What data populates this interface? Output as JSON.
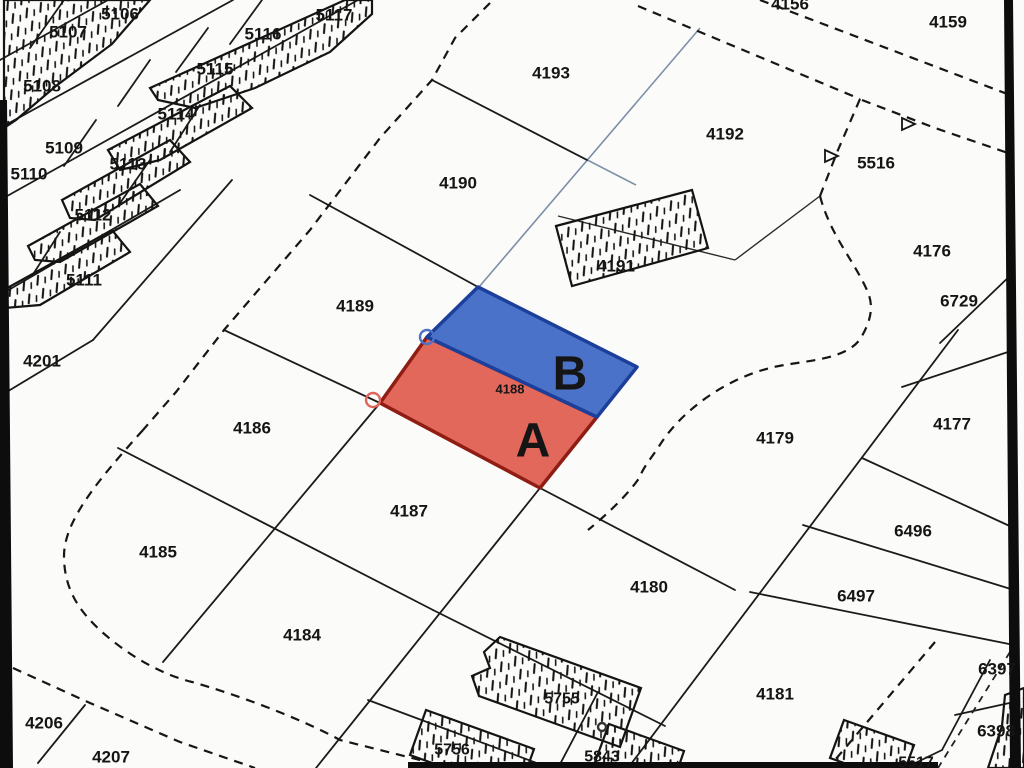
{
  "map": {
    "type": "cadastral-parcel-map",
    "background": "#fbfbf9",
    "ink_color": "#1b1b1b",
    "survey_line_color": "#7d8fa8",
    "highlight": {
      "parcel_number": "4188",
      "zone_a_label": "A",
      "zone_b_label": "B",
      "red_fill": "#e2685c",
      "red_edge": "#8f1d14",
      "blue_fill": "#4a72c8",
      "blue_edge": "#1d3f9c",
      "number_color": "#d03a2e"
    },
    "parcel_labels": [
      {
        "text": "5106",
        "x": 120,
        "y": 14,
        "size": 17
      },
      {
        "text": "5107",
        "x": 68,
        "y": 32,
        "size": 17
      },
      {
        "text": "5108",
        "x": 42,
        "y": 86,
        "size": 17
      },
      {
        "text": "5115",
        "x": 215,
        "y": 69,
        "size": 17
      },
      {
        "text": "5116",
        "x": 263,
        "y": 34,
        "size": 17
      },
      {
        "text": "5117",
        "x": 334,
        "y": 15,
        "size": 17
      },
      {
        "text": "5114",
        "x": 176,
        "y": 114,
        "size": 17
      },
      {
        "text": "5109",
        "x": 64,
        "y": 148,
        "size": 17
      },
      {
        "text": "5113",
        "x": 128,
        "y": 164,
        "size": 17
      },
      {
        "text": "5110",
        "x": 29,
        "y": 174,
        "size": 17
      },
      {
        "text": "5112",
        "x": 93,
        "y": 215,
        "size": 17
      },
      {
        "text": "5111",
        "x": 84,
        "y": 280,
        "size": 17
      },
      {
        "text": "4201",
        "x": 42,
        "y": 361,
        "size": 17
      },
      {
        "text": "4206",
        "x": 44,
        "y": 723,
        "size": 17
      },
      {
        "text": "4207",
        "x": 111,
        "y": 757,
        "size": 17
      },
      {
        "text": "4193",
        "x": 551,
        "y": 73,
        "size": 17
      },
      {
        "text": "4190",
        "x": 458,
        "y": 183,
        "size": 17
      },
      {
        "text": "4189",
        "x": 355,
        "y": 306,
        "size": 17
      },
      {
        "text": "4186",
        "x": 252,
        "y": 428,
        "size": 17
      },
      {
        "text": "4187",
        "x": 409,
        "y": 511,
        "size": 17
      },
      {
        "text": "4185",
        "x": 158,
        "y": 552,
        "size": 17
      },
      {
        "text": "4184",
        "x": 302,
        "y": 635,
        "size": 17
      },
      {
        "text": "4192",
        "x": 725,
        "y": 134,
        "size": 17
      },
      {
        "text": "4191",
        "x": 616,
        "y": 266,
        "size": 17
      },
      {
        "text": "4156",
        "x": 790,
        "y": 4,
        "size": 17
      },
      {
        "text": "4159",
        "x": 948,
        "y": 22,
        "size": 17
      },
      {
        "text": "5516",
        "x": 876,
        "y": 163,
        "size": 17
      },
      {
        "text": "4176",
        "x": 932,
        "y": 251,
        "size": 17
      },
      {
        "text": "6729",
        "x": 959,
        "y": 301,
        "size": 17
      },
      {
        "text": "4177",
        "x": 952,
        "y": 424,
        "size": 17
      },
      {
        "text": "4179",
        "x": 775,
        "y": 438,
        "size": 17
      },
      {
        "text": "6496",
        "x": 913,
        "y": 531,
        "size": 17
      },
      {
        "text": "6497",
        "x": 856,
        "y": 596,
        "size": 17
      },
      {
        "text": "4180",
        "x": 649,
        "y": 587,
        "size": 17
      },
      {
        "text": "4181",
        "x": 775,
        "y": 694,
        "size": 17
      },
      {
        "text": "6397",
        "x": 997,
        "y": 669,
        "size": 17
      },
      {
        "text": "6398",
        "x": 996,
        "y": 731,
        "size": 17
      },
      {
        "text": "5755",
        "x": 562,
        "y": 699,
        "size": 16
      },
      {
        "text": "5756",
        "x": 452,
        "y": 750,
        "size": 16
      },
      {
        "text": "5843",
        "x": 602,
        "y": 757,
        "size": 16
      },
      {
        "text": "5517",
        "x": 916,
        "y": 763,
        "size": 16
      },
      {
        "text": "4188",
        "x": 510,
        "y": 389,
        "size": 13,
        "color": "#d03a2e"
      },
      {
        "text": "B",
        "x": 570,
        "y": 374,
        "size": 48,
        "color": "#1d3f9c"
      },
      {
        "text": "A",
        "x": 533,
        "y": 441,
        "size": 48,
        "color": "#9c1b10"
      }
    ],
    "markers": {
      "circles": [
        {
          "x": 427,
          "y": 337,
          "r": 7,
          "color": "#4a72c8",
          "name": "survey-point-blue"
        },
        {
          "x": 373,
          "y": 400,
          "r": 7,
          "color": "#e0655a",
          "name": "survey-point-red"
        },
        {
          "x": 602,
          "y": 727,
          "r": 4,
          "color": "#333333",
          "name": "survey-point-small"
        }
      ],
      "triangles": [
        {
          "x": 908,
          "y": 124,
          "name": "benchmark-triangle-5516-east"
        },
        {
          "x": 831,
          "y": 156,
          "name": "benchmark-triangle-5516-west"
        }
      ]
    }
  }
}
